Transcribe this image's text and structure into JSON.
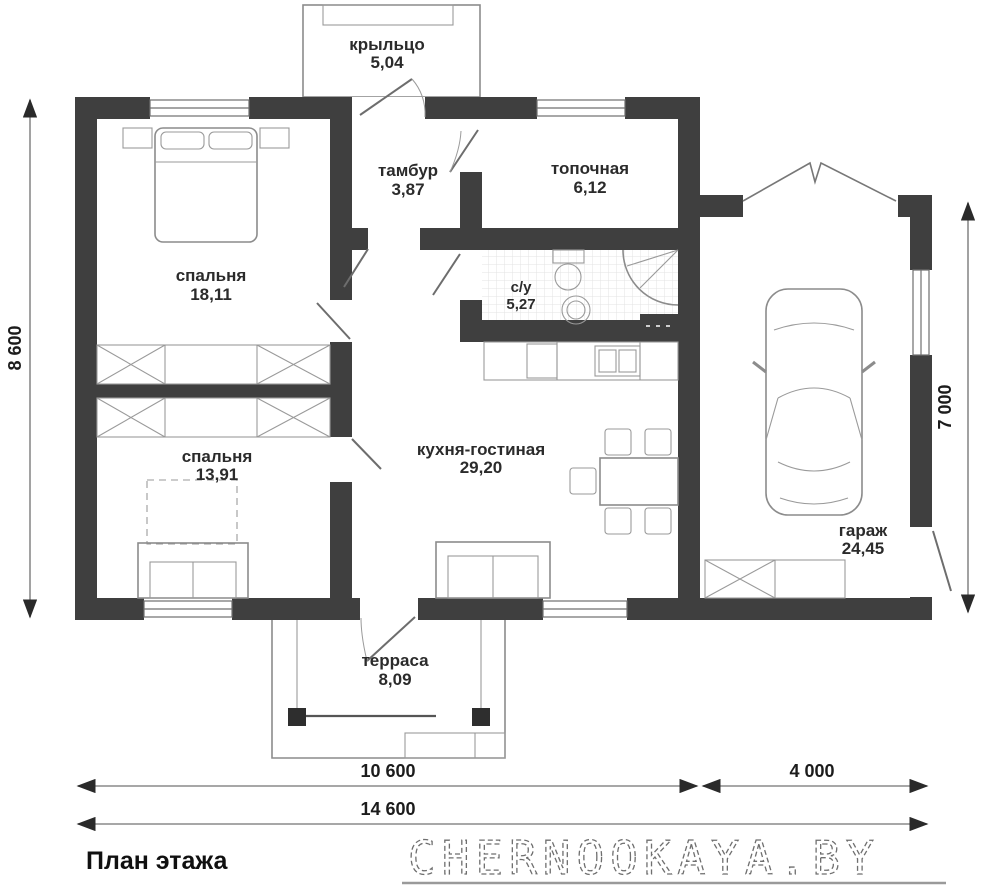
{
  "plan": {
    "title": "План этажа",
    "watermark": "CHERNOOKAYA.BY",
    "rooms": {
      "porch": {
        "name": "крыльцо",
        "area": "5,04"
      },
      "vestibule": {
        "name": "тамбур",
        "area": "3,87"
      },
      "boiler": {
        "name": "топочная",
        "area": "6,12"
      },
      "bedroom1": {
        "name": "спальня",
        "area": "18,11"
      },
      "bathroom": {
        "name": "с/у",
        "area": "5,27"
      },
      "kitchen": {
        "name": "кухня-гостиная",
        "area": "29,20"
      },
      "bedroom2": {
        "name": "спальня",
        "area": "13,91"
      },
      "garage": {
        "name": "гараж",
        "area": "24,45"
      },
      "terrace": {
        "name": "терраса",
        "area": "8,09"
      }
    },
    "dimensions": {
      "height_total": "8 600",
      "garage_height": "7 000",
      "width_main": "10 600",
      "width_garage": "4 000",
      "width_total": "14 600"
    },
    "colors": {
      "wall": "#3f3f3f",
      "line": "#8c8c8c",
      "text": "#1c1c1c"
    }
  }
}
